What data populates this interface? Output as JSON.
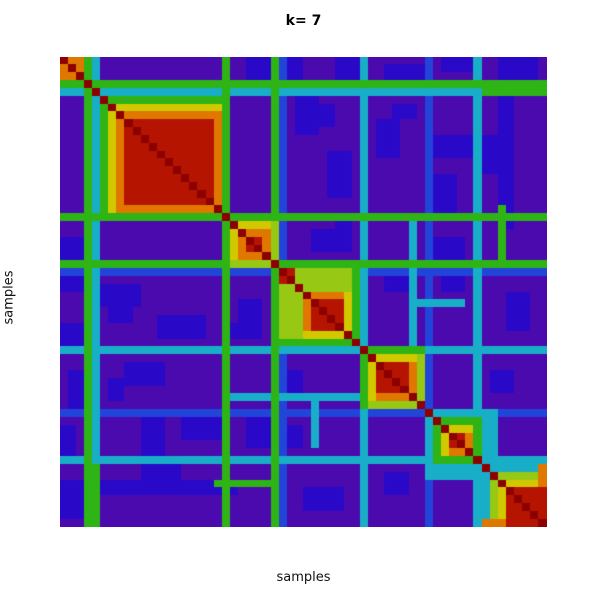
{
  "figure": {
    "kind": "consensus-clustering-heatmap"
  },
  "chart_data": {
    "type": "heatmap",
    "title": "k= 7",
    "xlabel": "samples",
    "ylabel": "samples",
    "legend": "none",
    "grid": "off",
    "n": 60,
    "value_scale": [
      0,
      9
    ],
    "background_value": 0,
    "diagonal_value": 9,
    "colormap": [
      "#4A0AAD",
      "#2A08C8",
      "#2244D8",
      "#18AEC8",
      "#2EB414",
      "#96C814",
      "#D2C800",
      "#E07800",
      "#B41400",
      "#8C0000"
    ],
    "clusters": [
      {
        "start": 0,
        "profile": [
          7,
          8,
          7
        ]
      },
      {
        "start": 5,
        "profile": [
          4,
          6,
          7,
          8,
          8,
          8,
          8,
          8,
          8,
          8,
          8,
          8,
          8,
          8,
          7
        ]
      },
      {
        "start": 20,
        "profile": [
          4,
          6,
          7,
          8,
          8,
          7,
          5
        ]
      },
      {
        "start": 27,
        "profile": [
          5,
          5,
          5,
          7,
          8,
          8,
          8,
          8,
          6,
          4
        ]
      },
      {
        "start": 37,
        "profile": [
          4,
          6,
          8,
          8,
          8,
          8,
          7,
          5
        ]
      },
      {
        "start": 45,
        "profile": [
          3,
          4,
          6,
          8,
          8,
          7,
          4
        ]
      },
      {
        "start": 52,
        "profile": [
          3,
          5,
          6,
          8,
          8,
          8,
          8,
          8
        ]
      }
    ],
    "streaks": [
      {
        "index": 3,
        "value": 4
      },
      {
        "index": 4,
        "value": 3
      },
      {
        "index": 20,
        "value": 4
      },
      {
        "index": 26,
        "value": 4
      },
      {
        "index": 27,
        "value": 2
      },
      {
        "index": 37,
        "value": 3
      },
      {
        "index": 45,
        "value": 2
      },
      {
        "index": 51,
        "value": 3
      }
    ],
    "patches": [
      {
        "r": [
          0,
          2
        ],
        "c": [
          23,
          29
        ],
        "v": 1
      },
      {
        "r": [
          0,
          2
        ],
        "c": [
          34,
          36
        ],
        "v": 1
      },
      {
        "r": [
          1,
          2
        ],
        "c": [
          40,
          44
        ],
        "v": 1
      },
      {
        "r": [
          0,
          1
        ],
        "c": [
          47,
          50
        ],
        "v": 1
      },
      {
        "r": [
          0,
          2
        ],
        "c": [
          55,
          58
        ],
        "v": 1
      },
      {
        "r": [
          6,
          8
        ],
        "c": [
          30,
          33
        ],
        "v": 1
      },
      {
        "r": [
          6,
          7
        ],
        "c": [
          41,
          43
        ],
        "v": 1
      },
      {
        "r": [
          10,
          12
        ],
        "c": [
          46,
          50
        ],
        "v": 1
      },
      {
        "r": [
          22,
          24
        ],
        "c": [
          31,
          34
        ],
        "v": 1
      },
      {
        "r": [
          23,
          25
        ],
        "c": [
          46,
          49
        ],
        "v": 1
      },
      {
        "r": [
          29,
          31
        ],
        "c": [
          5,
          9
        ],
        "v": 1
      },
      {
        "r": [
          33,
          35
        ],
        "c": [
          12,
          17
        ],
        "v": 1
      },
      {
        "r": [
          34,
          35
        ],
        "c": [
          21,
          24
        ],
        "v": 1
      },
      {
        "r": [
          39,
          41
        ],
        "c": [
          8,
          12
        ],
        "v": 1
      },
      {
        "r": [
          40,
          42
        ],
        "c": [
          28,
          29
        ],
        "v": 1
      },
      {
        "r": [
          46,
          48
        ],
        "c": [
          15,
          19
        ],
        "v": 1
      },
      {
        "r": [
          47,
          49
        ],
        "c": [
          27,
          29
        ],
        "v": 1
      },
      {
        "r": [
          52,
          54
        ],
        "c": [
          10,
          14
        ],
        "v": 1
      },
      {
        "r": [
          54,
          55
        ],
        "c": [
          0,
          21
        ],
        "v": 1
      },
      {
        "r": [
          55,
          57
        ],
        "c": [
          30,
          34
        ],
        "v": 1
      },
      {
        "r": [
          53,
          55
        ],
        "c": [
          40,
          42
        ],
        "v": 1
      },
      {
        "r": [
          4,
          4
        ],
        "c": [
          52,
          59
        ],
        "v": 4
      },
      {
        "r": [
          19,
          26
        ],
        "c": [
          54,
          54
        ],
        "v": 4
      },
      {
        "r": [
          43,
          43
        ],
        "c": [
          20,
          36
        ],
        "v": 3
      },
      {
        "r": [
          31,
          31
        ],
        "c": [
          44,
          49
        ],
        "v": 3
      },
      {
        "r": [
          45,
          51
        ],
        "c": [
          52,
          53
        ],
        "v": 3
      },
      {
        "r": [
          52,
          54
        ],
        "c": [
          59,
          59
        ],
        "v": 7
      },
      {
        "r": [
          27,
          28
        ],
        "c": [
          27,
          28
        ],
        "v": 8
      }
    ]
  }
}
